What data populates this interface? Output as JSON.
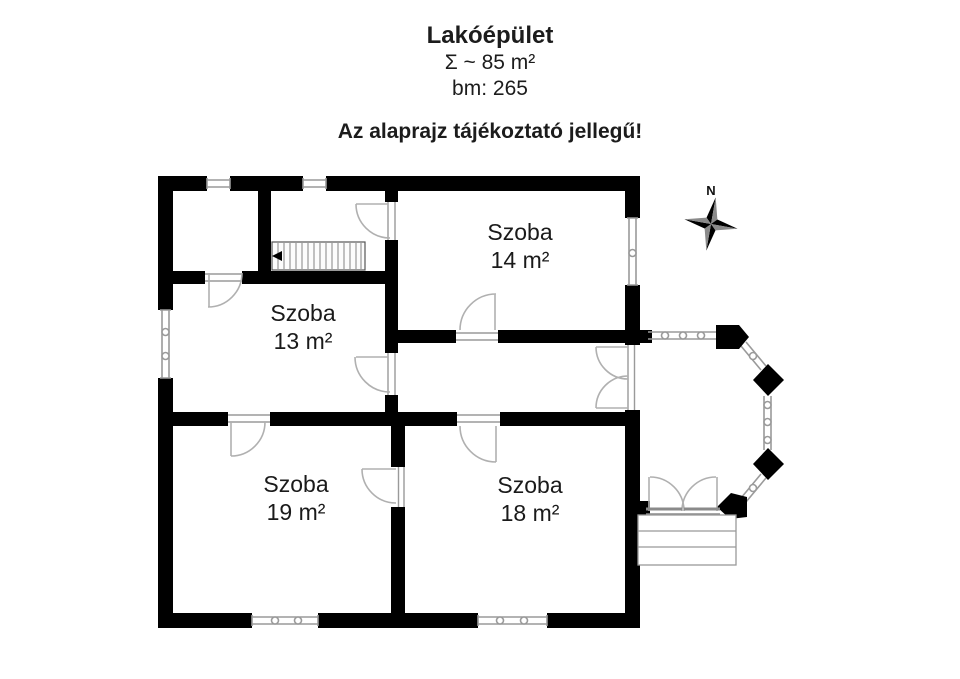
{
  "header": {
    "title": "Lakóépület",
    "area_total": "Σ ~ 85 m²",
    "bm": "bm: 265",
    "note": "Az alaprajz tájékoztató jellegű!"
  },
  "compass": {
    "north_label": "N"
  },
  "rooms": [
    {
      "name": "Szoba",
      "area": "14 m²"
    },
    {
      "name": "Szoba",
      "area": "13 m²"
    },
    {
      "name": "Szoba",
      "area": "19 m²"
    },
    {
      "name": "Szoba",
      "area": "18 m²"
    }
  ],
  "colors": {
    "wall": "#000000",
    "window": "#9a9a9a",
    "door_arc": "#b0b0b0",
    "stair_hatch": "#777777",
    "text": "#1a1a1a",
    "compass_dark": "#000000",
    "compass_light": "#8a8a8a"
  }
}
